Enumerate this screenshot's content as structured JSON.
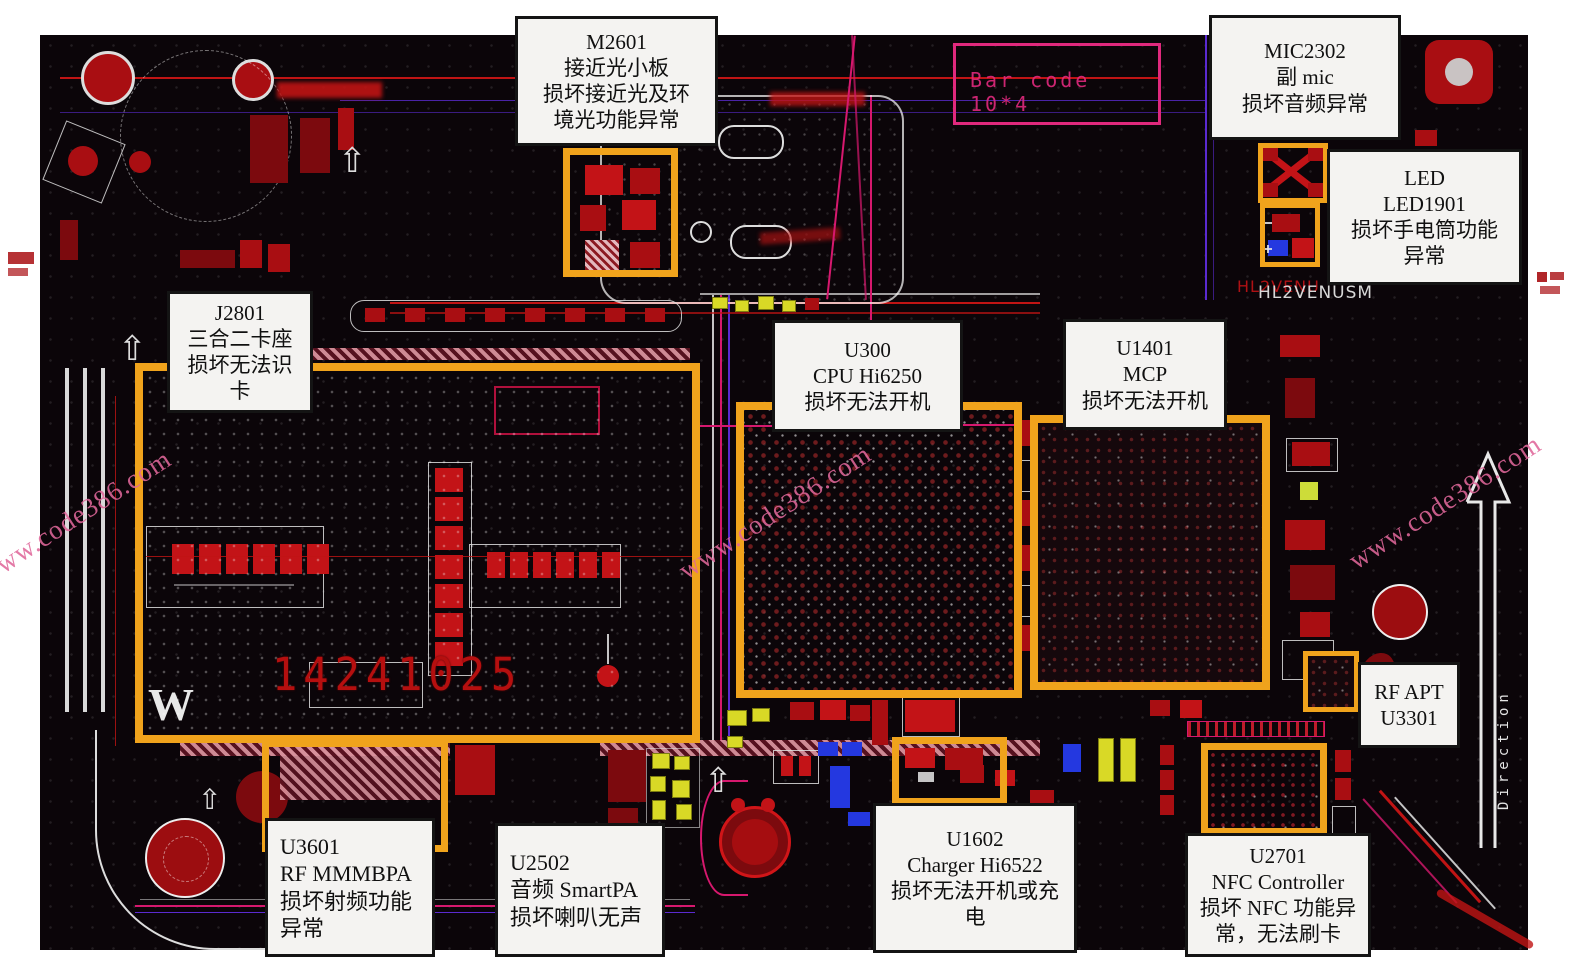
{
  "title": "HL2VENUSM 主板元件故障标注图",
  "board_texts": {
    "bar_code": "Bar code 10*4",
    "serial_number": "14241025",
    "silkscreen_red": "HL2VENU",
    "silkscreen_white": "HL2VENUSM",
    "direction_label": "Direction",
    "w_mark": "W"
  },
  "watermark": {
    "text": "www.code386.com",
    "color": "#e0679a"
  },
  "colors": {
    "highlight": "#f0a31c",
    "callout_bg": "#f4f3f1",
    "callout_border": "#141414",
    "board_bg": "#0b0509",
    "component_red": "#a90e12",
    "trace_magenta": "#d6186e",
    "trace_purple": "#5a2ad0",
    "component_yellow": "#d9d926",
    "component_blue": "#2438e0",
    "silk_white": "#e6e6e6",
    "barcode_pink": "#e0297d"
  },
  "callouts": {
    "m2601": {
      "lines": [
        "M2601",
        "接近光小板",
        "损坏接近光及环",
        "境光功能异常"
      ],
      "align": "center"
    },
    "mic2302": {
      "lines": [
        "MIC2302",
        "副 mic",
        "损坏音频异常"
      ],
      "align": "center"
    },
    "led1901": {
      "lines": [
        "LED",
        "LED1901",
        "损坏手电筒功能",
        "异常"
      ],
      "align": "center"
    },
    "j2801": {
      "lines": [
        "J2801",
        "三合二卡座",
        "损坏无法识",
        "卡"
      ],
      "align": "center"
    },
    "u300": {
      "lines": [
        "U300",
        "CPU Hi6250",
        "损坏无法开机"
      ],
      "align": "center"
    },
    "u1401": {
      "lines": [
        "U1401",
        "MCP",
        "损坏无法开机"
      ],
      "align": "center"
    },
    "rf_apt": {
      "lines": [
        "RF APT",
        "U3301"
      ],
      "align": "center"
    },
    "u3601": {
      "lines": [
        "U3601",
        "RF MMMBPA",
        "损坏射频功能",
        "异常"
      ],
      "align": "left"
    },
    "u2502": {
      "lines": [
        "U2502",
        "音频 SmartPA",
        "损坏喇叭无声"
      ],
      "align": "left"
    },
    "u1602": {
      "lines": [
        "U1602",
        "Charger Hi6522",
        "损坏无法开机或充",
        "电"
      ],
      "align": "center"
    },
    "u2701": {
      "lines": [
        "U2701",
        "NFC Controller",
        "损坏 NFC 功能异",
        "常，无法刷卡"
      ],
      "align": "center"
    }
  }
}
